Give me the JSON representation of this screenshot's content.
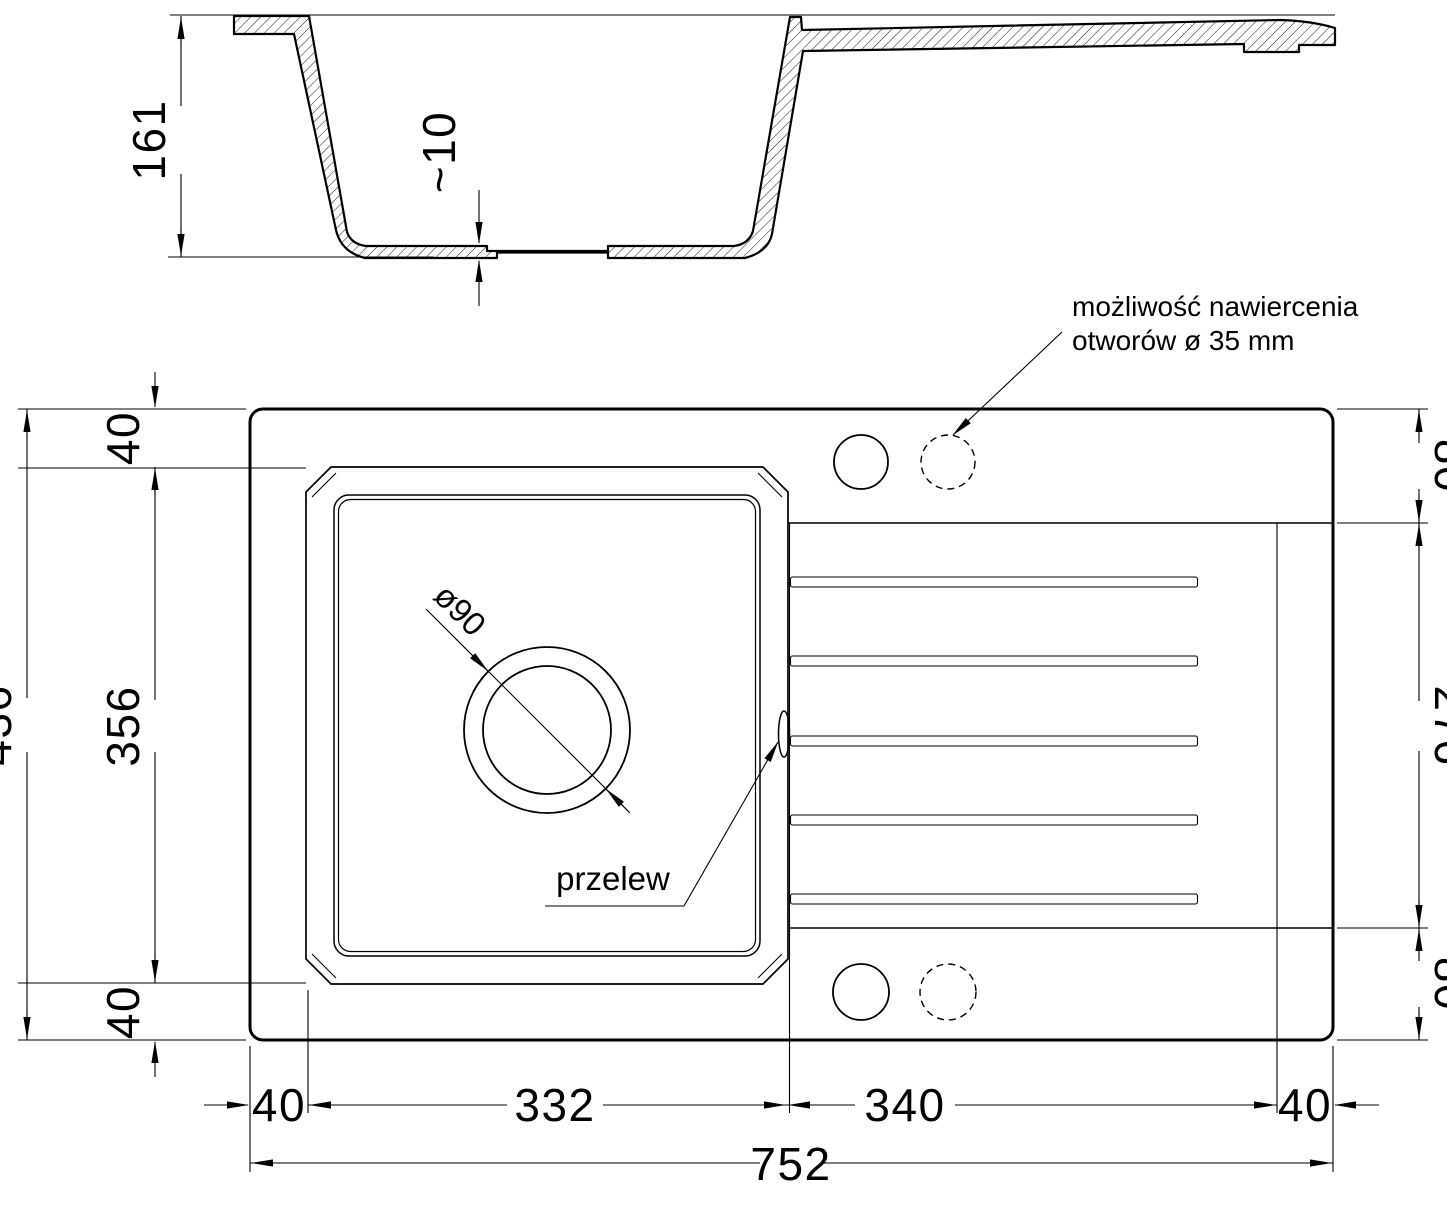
{
  "annotations": {
    "drill_note_line1": "możliwość nawiercenia",
    "drill_note_line2": "otworów ø 35 mm",
    "overflow_label": "przelew",
    "drain_diameter_label": "ø90"
  },
  "dimensions": {
    "section_depth": "161",
    "section_bottom_thickness": "~10",
    "plan": {
      "overall_height": "436",
      "left_top_margin": "40",
      "bowl_height": "356",
      "left_bottom_margin": "40",
      "right_top_band": "80",
      "drainer_band_height": "276",
      "right_bottom_band": "80",
      "bottom_left_margin": "40",
      "bowl_width": "332",
      "drainer_width": "340",
      "bottom_right_margin": "40",
      "overall_width": "752"
    }
  },
  "colors": {
    "ink": "#000000",
    "background": "#ffffff"
  }
}
